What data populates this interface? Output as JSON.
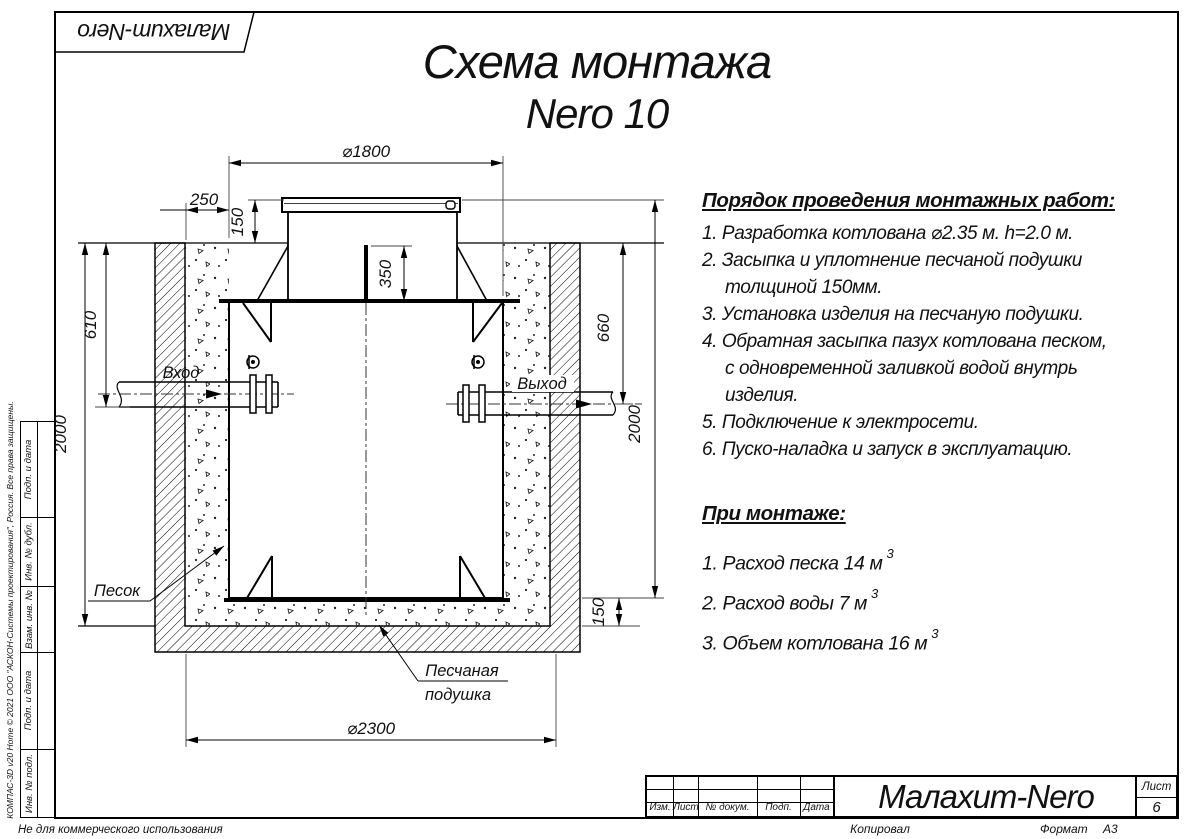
{
  "page": {
    "logo": "Малахит-Nero",
    "title_line1": "Схема монтажа",
    "title_line2": "Nero 10",
    "non_commercial_note": "Не для коммерческого использования",
    "side_copyright": "КОМПАС-3D v20 Home © 2021 ООО \"АСКОН-Системы проектирования\", Россия. Все права защищены.",
    "copied_label": "Копировал",
    "format_label": "Формат",
    "format_value": "А3"
  },
  "instructions": {
    "heading": "Порядок проведения монтажных работ:",
    "lines": [
      "1. Разработка котлована ⌀2.35 м. h=2.0 м.",
      "2. Засыпка и уплотнение песчаной подушки",
      "толщиной 150мм.",
      "3. Установка изделия на песчаную подушки.",
      "4. Обратная засыпка пазух котлована песком,",
      "с одновременной заливкой водой внутрь",
      "изделия.",
      "5. Подключение к электросети.",
      "6. Пуско-наладка и запуск в эксплуатацию."
    ]
  },
  "montage": {
    "heading": "При монтаже:",
    "items": [
      {
        "text": "1. Расход песка 14 м",
        "sup": "3"
      },
      {
        "text": "2. Расход воды 7 м",
        "sup": "3"
      },
      {
        "text": "3. Объем котлована 16 м",
        "sup": "3"
      }
    ]
  },
  "drawing": {
    "dims": {
      "top_diameter": "⌀1800",
      "offset_left": "250",
      "lid_height": "150",
      "rod_height": "350",
      "inlet_depth": "610",
      "outlet_depth": "660",
      "pit_depth_left": "2000",
      "pit_depth_right": "2000",
      "cushion_thickness": "150",
      "pit_diameter": "⌀2300"
    },
    "labels": {
      "inlet": "Вход",
      "outlet": "Выход",
      "sand": "Песок",
      "cushion_line1": "Песчаная",
      "cushion_line2": "подушка"
    }
  },
  "title_block": {
    "columns": [
      "Изм.",
      "Лист",
      "№ докум.",
      "Подп.",
      "Дата"
    ],
    "product": "Малахит-Nero",
    "sheet_label": "Лист",
    "sheet_number": "6"
  },
  "stamp_side": {
    "labels": [
      "Подп. и дата",
      "Инв. № дубл.",
      "Взам. инв. №",
      "Подп. и дата",
      "Инв. № подл."
    ]
  }
}
